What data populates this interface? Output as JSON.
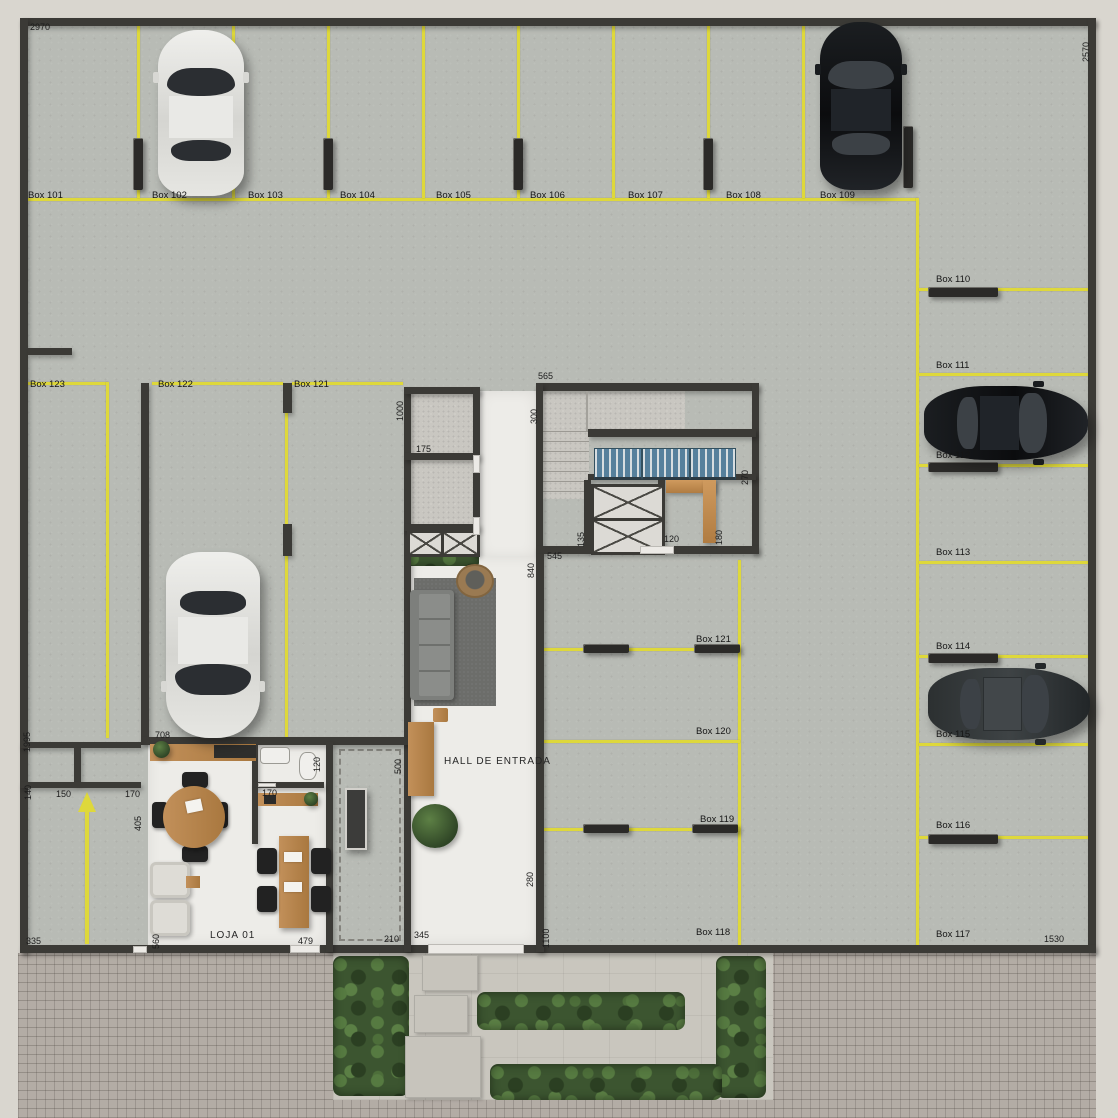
{
  "plan_title": "Ground floor garage plan",
  "colors": {
    "parking_line": "#ded83b",
    "wall": "#3b3a36",
    "floor_concrete": "#b8bbb5",
    "floor_white": "#edece8",
    "brick_paving": "#b3aca5",
    "hedge_green": "#3c5530",
    "wood": "#bc8a55",
    "bike_rack_blue": "#56809c"
  },
  "rooms": [
    {
      "label": "HALL DE ENTRADA",
      "x": 444,
      "y": 757
    },
    {
      "label": "LOJA 01",
      "x": 210,
      "y": 931
    }
  ],
  "parking_boxes": [
    {
      "label": "Box 101",
      "x": 28,
      "y": 191
    },
    {
      "label": "Box 102",
      "x": 152,
      "y": 191
    },
    {
      "label": "Box 103",
      "x": 248,
      "y": 191
    },
    {
      "label": "Box 104",
      "x": 340,
      "y": 191
    },
    {
      "label": "Box 105",
      "x": 436,
      "y": 191
    },
    {
      "label": "Box 106",
      "x": 530,
      "y": 191
    },
    {
      "label": "Box 107",
      "x": 628,
      "y": 191
    },
    {
      "label": "Box 108",
      "x": 726,
      "y": 191
    },
    {
      "label": "Box 109",
      "x": 820,
      "y": 191
    },
    {
      "label": "Box 110",
      "x": 936,
      "y": 275
    },
    {
      "label": "Box 111",
      "x": 936,
      "y": 361
    },
    {
      "label": "Box 112",
      "x": 936,
      "y": 451
    },
    {
      "label": "Box 113",
      "x": 936,
      "y": 548
    },
    {
      "label": "Box 114",
      "x": 936,
      "y": 642
    },
    {
      "label": "Box 115",
      "x": 936,
      "y": 730
    },
    {
      "label": "Box 116",
      "x": 936,
      "y": 821
    },
    {
      "label": "Box 117",
      "x": 936,
      "y": 930
    },
    {
      "label": "Box 123",
      "x": 30,
      "y": 380
    },
    {
      "label": "Box 122",
      "x": 158,
      "y": 380
    },
    {
      "label": "Box 121",
      "x": 294,
      "y": 380
    },
    {
      "label": "Box 121",
      "x": 696,
      "y": 635
    },
    {
      "label": "Box 120",
      "x": 696,
      "y": 727
    },
    {
      "label": "Box 119",
      "x": 700,
      "y": 815
    },
    {
      "label": "Box 118",
      "x": 696,
      "y": 928
    }
  ],
  "dimensions_horizontal": [
    {
      "text": "2970",
      "x": 30,
      "y": 22
    },
    {
      "text": "565",
      "x": 538,
      "y": 371
    },
    {
      "text": "175",
      "x": 416,
      "y": 444
    },
    {
      "text": "120",
      "x": 664,
      "y": 534
    },
    {
      "text": "545",
      "x": 547,
      "y": 551
    },
    {
      "text": "708",
      "x": 155,
      "y": 730
    },
    {
      "text": "150",
      "x": 56,
      "y": 789
    },
    {
      "text": "170",
      "x": 125,
      "y": 789
    },
    {
      "text": "170",
      "x": 262,
      "y": 788
    },
    {
      "text": "335",
      "x": 26,
      "y": 936
    },
    {
      "text": "479",
      "x": 298,
      "y": 936
    },
    {
      "text": "210",
      "x": 384,
      "y": 934
    },
    {
      "text": "345",
      "x": 414,
      "y": 930
    },
    {
      "text": "1530",
      "x": 1044,
      "y": 934
    }
  ],
  "dimensions_vertical": [
    {
      "text": "2570",
      "x": 1081,
      "y": 62
    },
    {
      "text": "1000",
      "x": 395,
      "y": 421
    },
    {
      "text": "300",
      "x": 529,
      "y": 424
    },
    {
      "text": "270",
      "x": 740,
      "y": 485
    },
    {
      "text": "135",
      "x": 576,
      "y": 547
    },
    {
      "text": "180",
      "x": 714,
      "y": 545
    },
    {
      "text": "840",
      "x": 526,
      "y": 578
    },
    {
      "text": "1995",
      "x": 22,
      "y": 752
    },
    {
      "text": "140",
      "x": 23,
      "y": 800
    },
    {
      "text": "405",
      "x": 133,
      "y": 831
    },
    {
      "text": "120",
      "x": 312,
      "y": 772
    },
    {
      "text": "500",
      "x": 393,
      "y": 774
    },
    {
      "text": "560",
      "x": 151,
      "y": 949
    },
    {
      "text": "280",
      "x": 525,
      "y": 887
    },
    {
      "text": "1100",
      "x": 541,
      "y": 948
    }
  ],
  "cars": [
    {
      "color": "white",
      "facing": "up",
      "parked_at": "Box 102"
    },
    {
      "color": "black",
      "facing": "up",
      "parked_at": "Box 109"
    },
    {
      "color": "black",
      "facing": "right",
      "parked_at": "Box 111"
    },
    {
      "color": "dark-grey",
      "facing": "right",
      "parked_at": "Box 114"
    },
    {
      "color": "white",
      "facing": "down",
      "parked_at": "Box 122"
    }
  ]
}
